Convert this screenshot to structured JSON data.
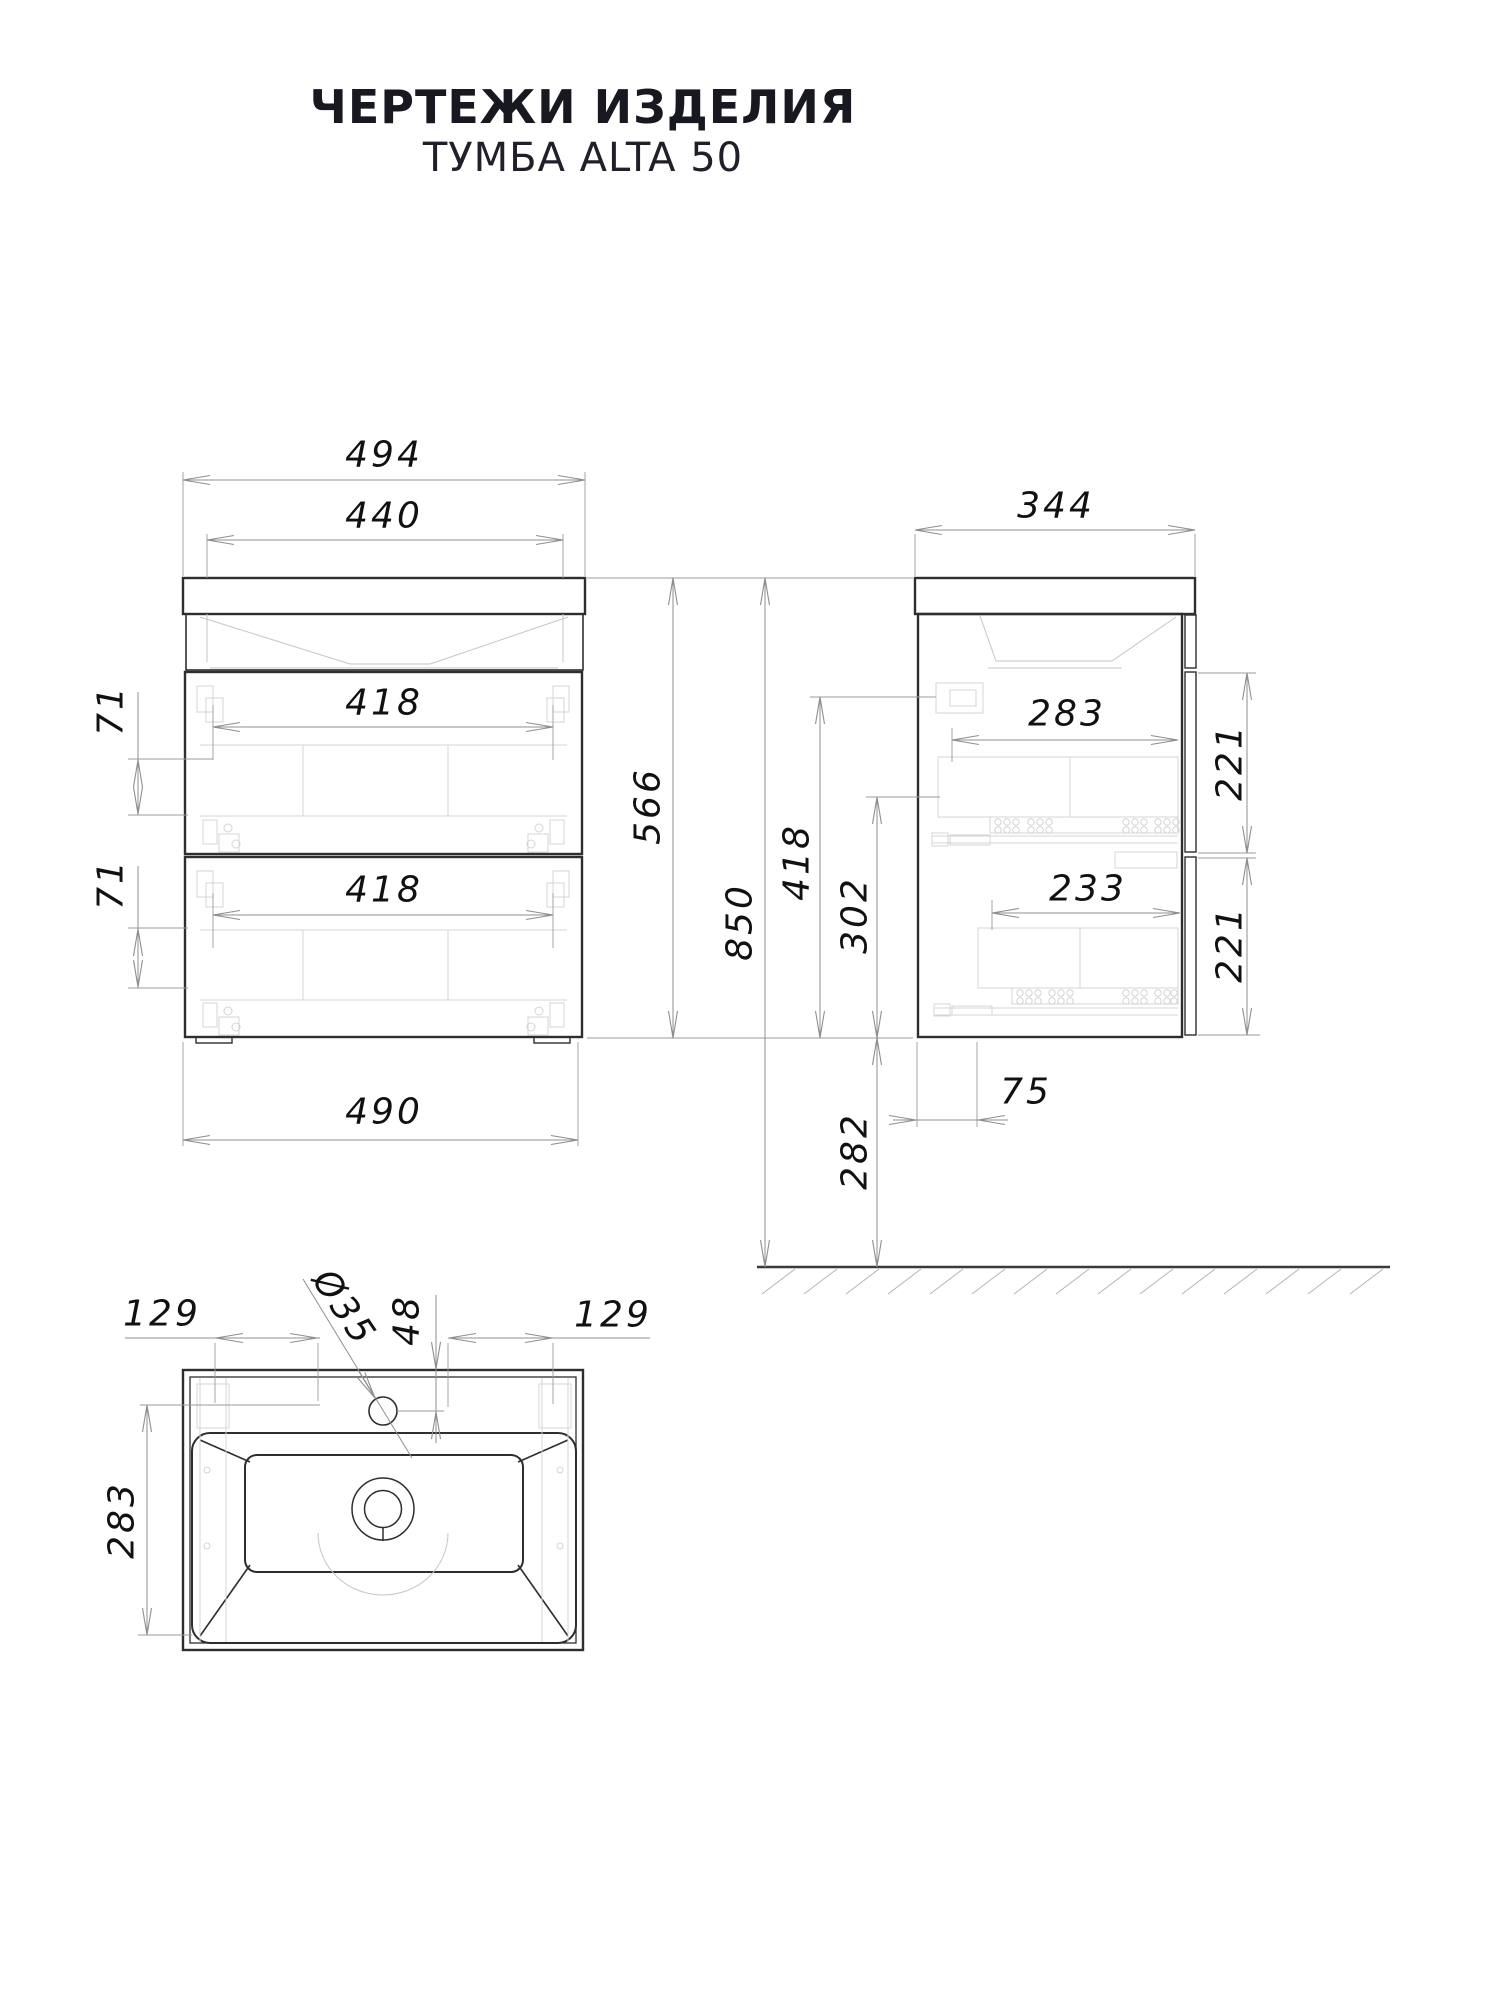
{
  "title": "ЧЕРТЕЖИ ИЗДЕЛИЯ",
  "subtitle": "ТУМБА ALTA 50",
  "colors": {
    "outline": "#2e2e2e",
    "dimension_lines": "#8f8f8f",
    "hardware_detail": "#d4d4d4",
    "text": "#111111",
    "background": "#ffffff"
  },
  "front_view": {
    "dim_overall_width": "494",
    "dim_inner_width": "440",
    "dim_drawer1_width": "418",
    "dim_drawer2_width": "418",
    "dim_gap_top": "71",
    "dim_gap_bottom": "71",
    "dim_body_height": "566",
    "dim_bottom_width": "490"
  },
  "side_view": {
    "dim_depth": "344",
    "dim_drawer1_depth": "283",
    "dim_drawer2_depth": "233",
    "dim_front1_height": "221",
    "dim_front2_height": "221",
    "dim_height_418": "418",
    "dim_height_302": "302",
    "dim_total_height": "850",
    "dim_floor_clearance": "282",
    "dim_back_offset": "75"
  },
  "top_view": {
    "dim_left_offset": "129",
    "dim_right_offset": "129",
    "dim_hole_diameter": "Ø35",
    "dim_hole_offset": "48",
    "dim_basin_depth": "283"
  }
}
